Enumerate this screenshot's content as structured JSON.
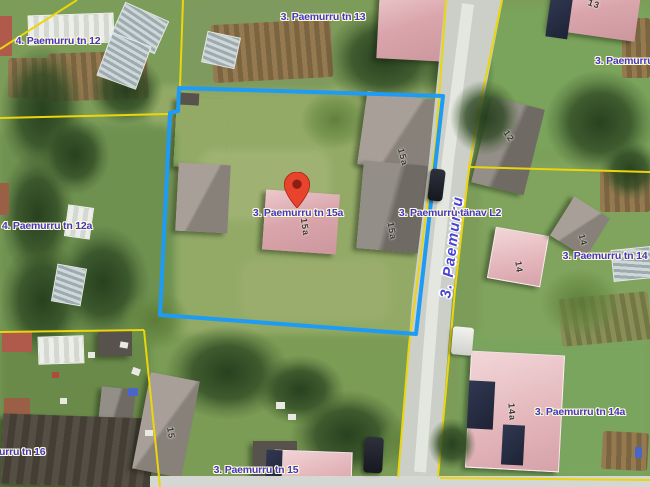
{
  "map": {
    "address_labels": [
      {
        "id": "tn12",
        "text": "4. Paemurru tn 12",
        "x": 58,
        "y": 41,
        "anchor": "center"
      },
      {
        "id": "tn13",
        "text": "3. Paemurru tn 13",
        "x": 323,
        "y": 17,
        "anchor": "center"
      },
      {
        "id": "tn13-right",
        "text": "3. Paemurru tn 1",
        "x": 595,
        "y": 61,
        "anchor": "left"
      },
      {
        "id": "tn12a",
        "text": "4. Paemurru tn 12a",
        "x": 47,
        "y": 226,
        "anchor": "center"
      },
      {
        "id": "tn15a",
        "text": "3. Paemurru tn 15a",
        "x": 298,
        "y": 213,
        "anchor": "center"
      },
      {
        "id": "tanav-l2",
        "text": "3. Paemurru tänav L2",
        "x": 450,
        "y": 213,
        "anchor": "center"
      },
      {
        "id": "tn14",
        "text": "3. Paemurru tn 14",
        "x": 605,
        "y": 256,
        "anchor": "center"
      },
      {
        "id": "tn14a",
        "text": "3. Paemurru tn 14a",
        "x": 580,
        "y": 412,
        "anchor": "center"
      },
      {
        "id": "tn16",
        "text": "urru tn 16",
        "x": -1,
        "y": 452,
        "anchor": "left"
      },
      {
        "id": "tn15",
        "text": "3. Paemurru tn 15",
        "x": 256,
        "y": 470,
        "anchor": "center"
      }
    ],
    "street_label": {
      "text": "3. Paemurru",
      "x": 452,
      "y": 247,
      "rotation": -83
    },
    "building_numbers": [
      {
        "text": "13",
        "x": 594,
        "y": 4,
        "rot": 18
      },
      {
        "text": "12",
        "x": 509,
        "y": 136,
        "rot": 55
      },
      {
        "text": "15a",
        "x": 305,
        "y": 227,
        "rot": 82
      },
      {
        "text": "15a",
        "x": 403,
        "y": 157,
        "rot": 75
      },
      {
        "text": "15a",
        "x": 392,
        "y": 231,
        "rot": 80
      },
      {
        "text": "14",
        "x": 519,
        "y": 267,
        "rot": 82
      },
      {
        "text": "14",
        "x": 583,
        "y": 240,
        "rot": 75
      },
      {
        "text": "14a",
        "x": 512,
        "y": 412,
        "rot": 86
      },
      {
        "text": "15",
        "x": 171,
        "y": 433,
        "rot": 80
      }
    ],
    "selected_parcel_address": "3. Paemurru tn 15a"
  },
  "colors": {
    "address_label_text": "#4236c8",
    "street_label_text": "#4a43d4",
    "label_halo": "#fdfad2",
    "building_number_text": "#3c362e",
    "cadastral_line": "#ecd50b",
    "selected_parcel_outline": "#1d9bf5",
    "pin_fill": "#e8432d",
    "pin_dark": "#8a1f12",
    "road_surface": "#cbcfc7"
  }
}
